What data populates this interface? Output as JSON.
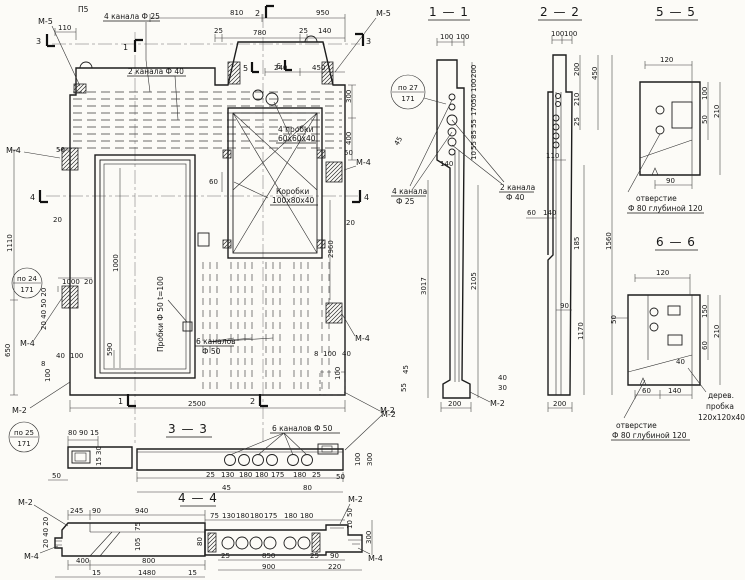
{
  "main": {
    "flag_3l": "3",
    "flag_1t": "1",
    "flag_2t": "2",
    "flag_3r": "3",
    "flag_4l": "4",
    "flag_4r": "4",
    "flag_1b": "1",
    "flag_2b": "2",
    "flag_5": "5",
    "flag_6": "6",
    "m5_tl": "М-5",
    "m5_tr": "М-5",
    "m4_l1": "М-4",
    "m4_l2": "М-4",
    "m4_r1": "М-4",
    "m4_r2": "М-4",
    "m2_bl": "М-2",
    "m2_br": "М-2",
    "p5": "П5",
    "ch25": "4 канала Ф 25",
    "ch40": "2 канала Ф 40",
    "plugs_l1": "4 пробки",
    "plugs_l2": "60х60х40",
    "boxes_l1": "Коробки",
    "boxes_l2": "100х80х40",
    "plugs_rot": "Пробки Ф 50  t=100",
    "ch50_l1": "6 каналов",
    "ch50_l2": "Ф 50",
    "po27": "по 27",
    "po24": "по 24",
    "po25": "по 25",
    "sheet": "171",
    "d110": "110",
    "d810": "810",
    "d950": "950",
    "d25a": "25",
    "d780": "780",
    "d25b": "25",
    "d140": "140",
    "d240": "240",
    "d450": "450",
    "d300": "300",
    "d400": "400",
    "d50r": "50",
    "d20r": "20",
    "d60w": "60",
    "d2960": "2960",
    "d8br": "8",
    "d100br": "100",
    "d40br": "40",
    "d100brv": "100",
    "d50l": "50",
    "d20l": "20",
    "d1110": "1110",
    "d650": "650",
    "d1000": "1000",
    "d20l2": "20",
    "lstack": "20 40 50 20",
    "d40bl": "40",
    "d100bl": "100",
    "d8bl": "8",
    "d100blv": "100",
    "d1000d": "1000",
    "d590": "590",
    "d2500": "2500"
  },
  "s11": {
    "title": "1 — 1",
    "d100a": "100",
    "d100b": "100",
    "po27": "по 27",
    "sheet": "171",
    "rstack": [
      "200",
      "100",
      "50",
      "170",
      "55",
      "85",
      "55",
      "10"
    ],
    "d140": "140",
    "d45": "45",
    "ch25_l1": "4 канала",
    "ch25_l2": "Ф 25",
    "ch40_l1": "2 канала",
    "ch40_l2": "Ф 40",
    "d3017": "3017",
    "d2105": "2105",
    "d45b": "45",
    "d55b": "55",
    "d40b": "40",
    "d30b": "30",
    "d200": "200",
    "m2": "М-2"
  },
  "s22": {
    "title": "2 — 2",
    "d100a": "100",
    "d100b": "100",
    "d200r": "200",
    "d210": "210",
    "d450": "450",
    "d25": "25",
    "d110": "110",
    "d60": "60",
    "d140": "140",
    "d185": "185",
    "d90": "90",
    "d1170": "1170",
    "d1560": "1560",
    "d200b": "200"
  },
  "s55": {
    "title": "5 — 5",
    "d120": "120",
    "d100": "100",
    "d50": "50",
    "d210": "210",
    "d90": "90",
    "note1": "отверстие",
    "note2": "Ф 80 глубиной 120"
  },
  "s66": {
    "title": "6 — 6",
    "d120": "120",
    "d50": "50",
    "d150": "150",
    "d60": "60",
    "d210": "210",
    "d40": "40",
    "d60b": "60",
    "d140": "140",
    "note1": "отверстие",
    "note2": "Ф 80 глубиной 120",
    "plug1": "дерев.",
    "plug2": "пробка",
    "plug3": "120х120х40"
  },
  "s33": {
    "title": "3 — 3",
    "label": "6 каналов Ф 50",
    "d80": "80",
    "d90": "90",
    "d15": "15",
    "d30v": "30",
    "d15v": "15",
    "d50l": "50",
    "row": [
      "25",
      "130",
      "180",
      "180",
      "175",
      "180",
      "25"
    ],
    "d45": "45",
    "d80b": "80",
    "d50r": "50",
    "d100v": "100",
    "d300v": "300",
    "m2": "М-2"
  },
  "s44": {
    "title": "4 — 4",
    "m2_l": "М-2",
    "m4_l": "М-4",
    "m2_r": "М-2",
    "m4_r": "М-4",
    "d245": "245",
    "d90": "90",
    "d940": "940",
    "row": [
      "75",
      "130",
      "180",
      "180",
      "175",
      "180",
      "180"
    ],
    "lstack": "20 40 20",
    "d75": "75",
    "d105": "105",
    "d80": "80",
    "d400": "400",
    "d800": "800",
    "d15a": "15",
    "d1480": "1480",
    "d15b": "15",
    "d25a": "25",
    "d850": "850",
    "d25b": "25",
    "d90r": "90",
    "d900": "900",
    "d220": "220",
    "d300": "300",
    "d50": "50",
    "d10": "10"
  }
}
